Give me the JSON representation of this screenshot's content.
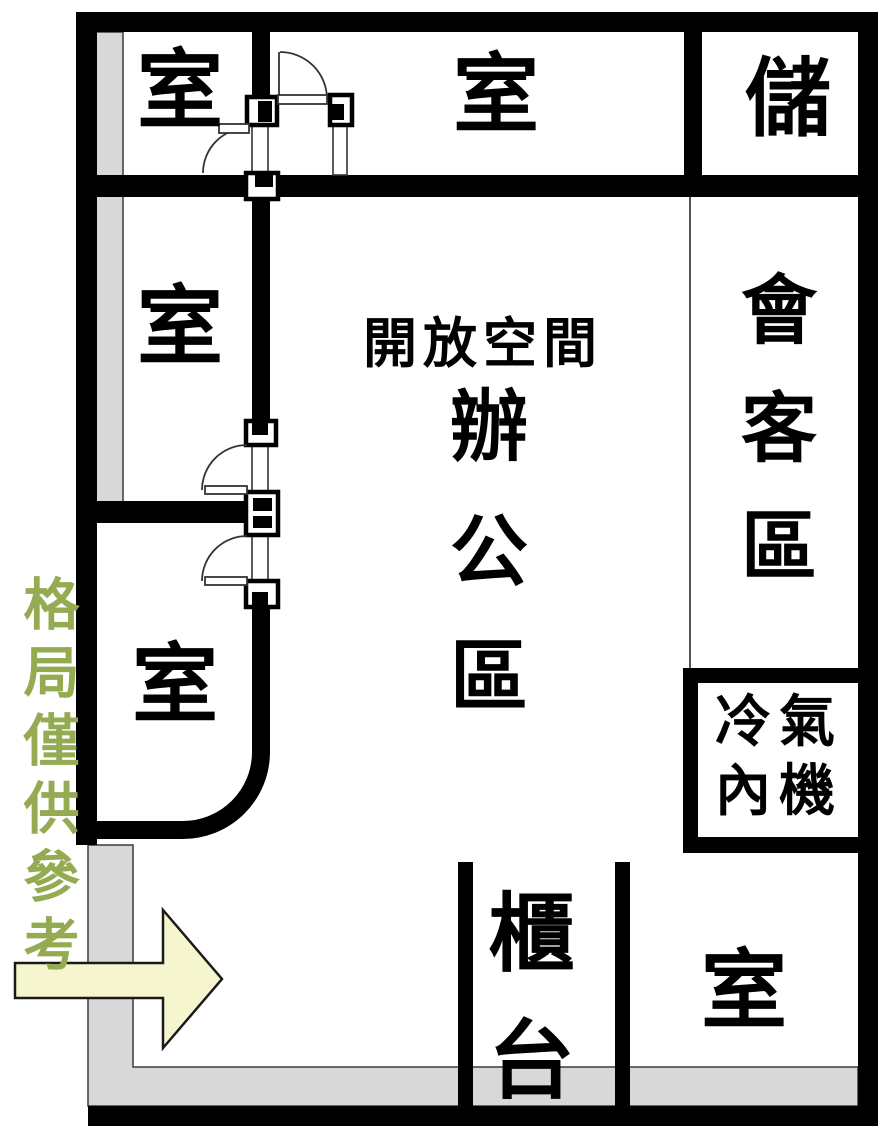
{
  "plan_note": "格局僅供參考",
  "rooms": {
    "top_left": {
      "label": "室"
    },
    "top_middle": {
      "label": "室"
    },
    "storage": {
      "label": "儲"
    },
    "mid_left": {
      "label": "室"
    },
    "reception": {
      "label": "會客區"
    },
    "open_office": {
      "line1": "開放空間",
      "line2": "辦公區"
    },
    "bottom_left": {
      "label": "室"
    },
    "ac_indoor_unit": {
      "line1": "冷氣",
      "line2": "內機"
    },
    "counter": {
      "label": "櫃台"
    },
    "bottom_right": {
      "label": "室"
    }
  },
  "icons": {
    "entrance_arrow": "entrance-arrow"
  },
  "colors": {
    "wall": "#000000",
    "note_green": "#94ab52",
    "arrow_fill": "#f6f6ce",
    "gray_strip": "#d8d8d8"
  }
}
